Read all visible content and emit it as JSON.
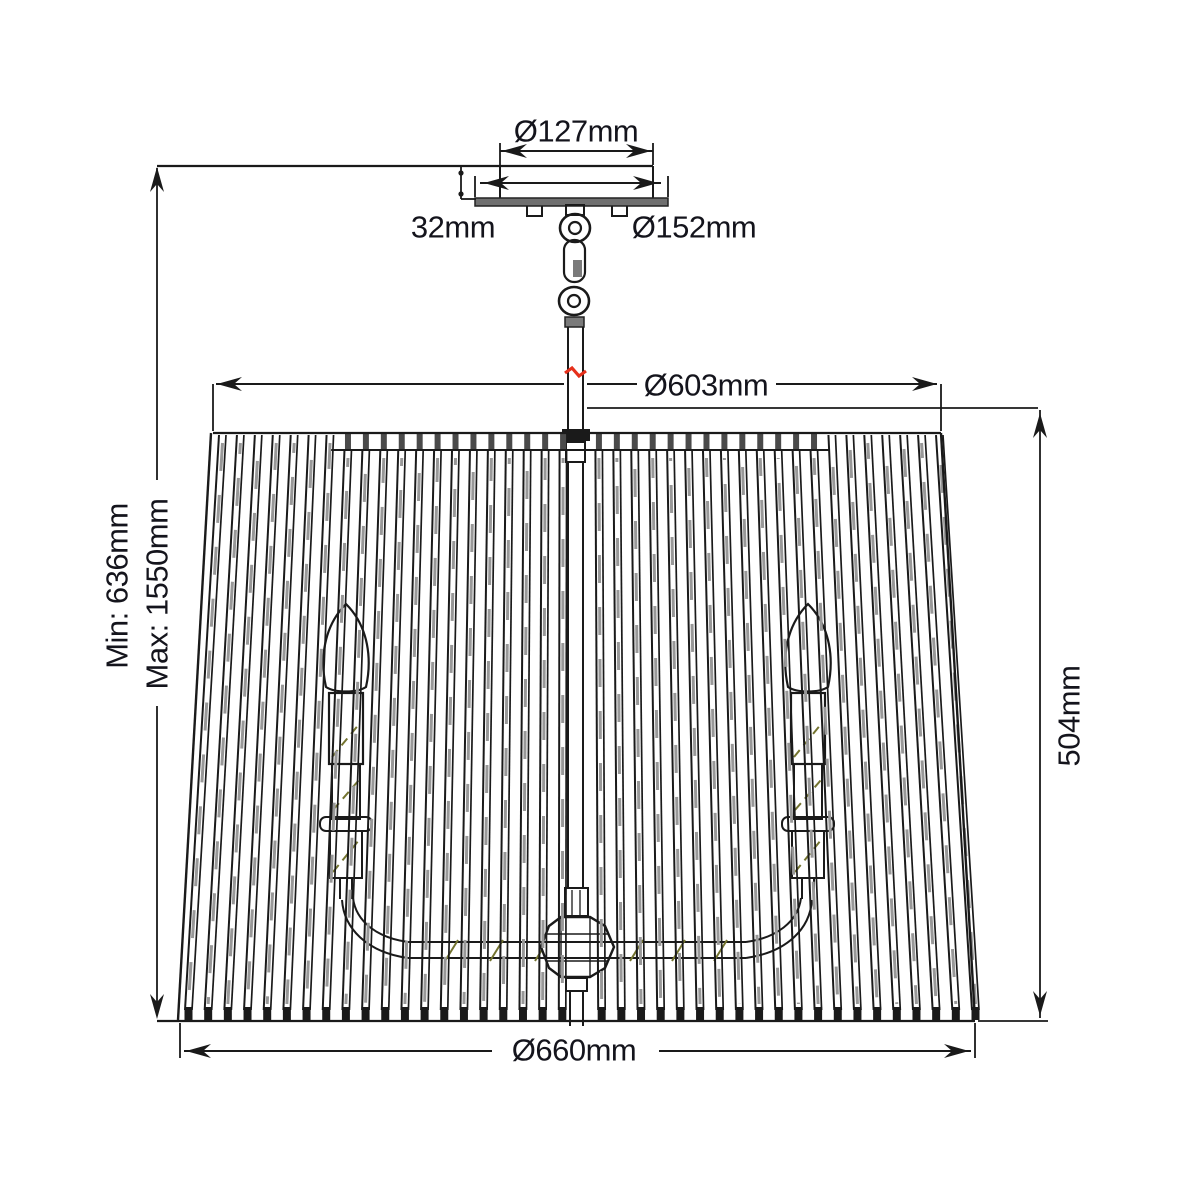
{
  "dimensions": {
    "canopy_inner_diameter": "Ø127mm",
    "canopy_height": "32mm",
    "canopy_diameter": "Ø152mm",
    "shade_top_diameter": "Ø603mm",
    "drop_min": "Min: 636mm",
    "drop_max": "Max: 1550mm",
    "shade_height": "504mm",
    "shade_bottom_diameter": "Ø660mm"
  },
  "colors": {
    "background": "#ffffff",
    "line": "#1a1a1a",
    "text": "#14141c",
    "slat_shade": "#989898",
    "rim_tick": "#4a4a4a",
    "metal_fill": "#6f6f6f",
    "break_mark": "#e6301b",
    "hatch": "#74742f"
  }
}
